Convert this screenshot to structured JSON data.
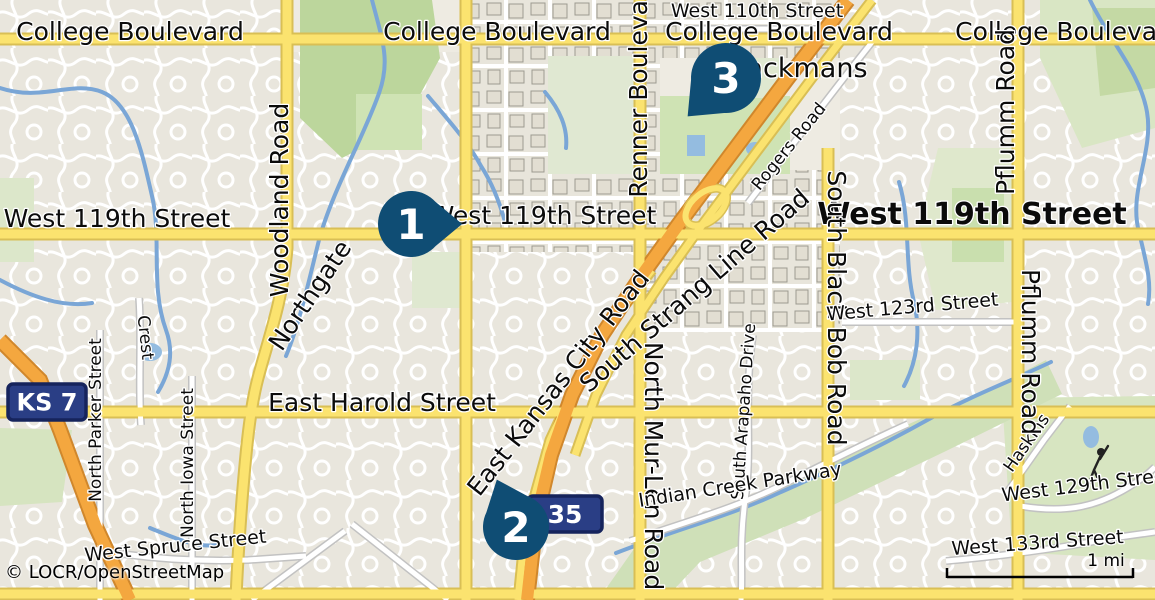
{
  "map": {
    "attribution": "© LOCR/OpenStreetMap",
    "scale": {
      "label": "1 mi"
    },
    "colors": {
      "land": "#eeebe2",
      "road_major_fill": "#fbe36f",
      "road_major_casing": "#d9bf55",
      "motorway_fill": "#f4a73f",
      "motorway_casing": "#d0872c",
      "minor_road_fill": "#ffffff",
      "minor_road_casing": "#c2c2c2",
      "water": "#7aa6d6",
      "pond": "#94bce0",
      "green_park": "#cfe3b4",
      "green_forest": "#bcd69c",
      "marker_fill": "#0f4d74",
      "marker_number": "#ffffff",
      "shield_fill": "#2a3e85",
      "shield_border": "#16245c",
      "shield_text": "#ffffff"
    },
    "markers": [
      {
        "number": "1",
        "x": 411,
        "y": 224,
        "r": 33,
        "tail_angle": 0
      },
      {
        "number": "2",
        "x": 516,
        "y": 527,
        "r": 33,
        "tail_angle": -112
      },
      {
        "number": "3",
        "x": 726,
        "y": 78,
        "r": 35,
        "tail_angle": 135
      }
    ],
    "shields": [
      {
        "name": "ks-7-shield",
        "text": "KS 7",
        "x": 8,
        "y": 384,
        "w": 78,
        "h": 36,
        "size": 24
      },
      {
        "name": "i-35-shield",
        "text": "35",
        "x": 528,
        "y": 496,
        "w": 74,
        "h": 36,
        "size": 25
      }
    ],
    "labels": [
      {
        "name": "college-boulevard-west",
        "text": "College Boulevard",
        "x": 130,
        "y": 40,
        "rot": 0,
        "size": 25
      },
      {
        "name": "college-boulevard-center",
        "text": "College Boulevard",
        "x": 497,
        "y": 40,
        "rot": 0,
        "size": 25
      },
      {
        "name": "west-110th-street",
        "text": "West 110th Street",
        "x": 757,
        "y": 17,
        "rot": 0,
        "size": 19
      },
      {
        "name": "college-boulevard-east1",
        "text": "College Boulevard",
        "x": 779,
        "y": 40,
        "rot": 0,
        "size": 25
      },
      {
        "name": "college-boulevard-east2",
        "text": "College Boulevard",
        "x": 1069,
        "y": 40,
        "rot": 0,
        "size": 25
      },
      {
        "name": "ackmans-place",
        "text": "ackmans",
        "x": 807,
        "y": 77,
        "rot": 0,
        "size": 27
      },
      {
        "name": "renner-boulevard",
        "text": "Renner Boulevard",
        "x": 647,
        "y": 86,
        "rot": -90,
        "size": 25
      },
      {
        "name": "rogers-road",
        "text": "Rogers Road",
        "x": 793,
        "y": 150,
        "rot": -51,
        "size": 17
      },
      {
        "name": "pflumm-road-north",
        "text": "Pflumm Road",
        "x": 1014,
        "y": 112,
        "rot": -90,
        "size": 25
      },
      {
        "name": "west-119th-street-west",
        "text": "West 119th Street",
        "x": 117,
        "y": 227,
        "rot": 0,
        "size": 25
      },
      {
        "name": "west-119th-street-center",
        "text": "West 119th Street",
        "x": 543,
        "y": 224,
        "rot": 0,
        "size": 25
      },
      {
        "name": "west-119th-street-east",
        "text": "West 119th Street",
        "x": 972,
        "y": 224,
        "rot": 0,
        "size": 30,
        "weight": "bold"
      },
      {
        "name": "woodland-road",
        "text": "Woodland Road",
        "x": 288,
        "y": 200,
        "rot": -90,
        "size": 25
      },
      {
        "name": "northgate",
        "text": "Northgate",
        "x": 317,
        "y": 300,
        "rot": -56,
        "size": 25
      },
      {
        "name": "south-strang-line-road",
        "text": "South Strang Line Road",
        "x": 700,
        "y": 297,
        "rot": -41,
        "size": 25
      },
      {
        "name": "south-black-bob-road",
        "text": "South Black Bob Road",
        "x": 828,
        "y": 308,
        "rot": 90,
        "size": 25
      },
      {
        "name": "west-123rd-street",
        "text": "West 123rd Street",
        "x": 913,
        "y": 313,
        "rot": -5,
        "size": 19
      },
      {
        "name": "crest",
        "text": "Crest",
        "x": 140,
        "y": 338,
        "rot": 84,
        "size": 17
      },
      {
        "name": "north-parker-street",
        "text": "North Parker Street",
        "x": 101,
        "y": 420,
        "rot": -90,
        "size": 17
      },
      {
        "name": "north-iowa-street",
        "text": "North Iowa Street",
        "x": 193,
        "y": 463,
        "rot": -90,
        "size": 17
      },
      {
        "name": "east-harold-street",
        "text": "East Harold Street",
        "x": 382,
        "y": 411,
        "rot": 0,
        "size": 25
      },
      {
        "name": "east-kansas-city-road",
        "text": "East Kansas City Road",
        "x": 565,
        "y": 388,
        "rot": -52,
        "size": 25
      },
      {
        "name": "north-mur-len-road",
        "text": "North Mur-Len Road",
        "x": 645,
        "y": 466,
        "rot": 90,
        "size": 25
      },
      {
        "name": "south-arapaho-drive",
        "text": "South Arapaho Drive",
        "x": 749,
        "y": 412,
        "rot": -86,
        "size": 17
      },
      {
        "name": "indian-creek-parkway",
        "text": "Indian Creek Parkway",
        "x": 741,
        "y": 491,
        "rot": -9,
        "size": 19
      },
      {
        "name": "haskins",
        "text": "Haskins",
        "x": 1031,
        "y": 446,
        "rot": -55,
        "size": 17
      },
      {
        "name": "west-129th-street",
        "text": "West 129th Street",
        "x": 1088,
        "y": 491,
        "rot": -7,
        "size": 19
      },
      {
        "name": "pflumm-road-south",
        "text": "Pflumm Road",
        "x": 1022,
        "y": 352,
        "rot": 90,
        "size": 25
      },
      {
        "name": "west-133rd-street",
        "text": "West 133rd Street",
        "x": 1038,
        "y": 549,
        "rot": -4,
        "size": 19
      },
      {
        "name": "west-spruce-street",
        "text": "West Spruce Street",
        "x": 176,
        "y": 552,
        "rot": -6,
        "size": 19
      }
    ]
  }
}
